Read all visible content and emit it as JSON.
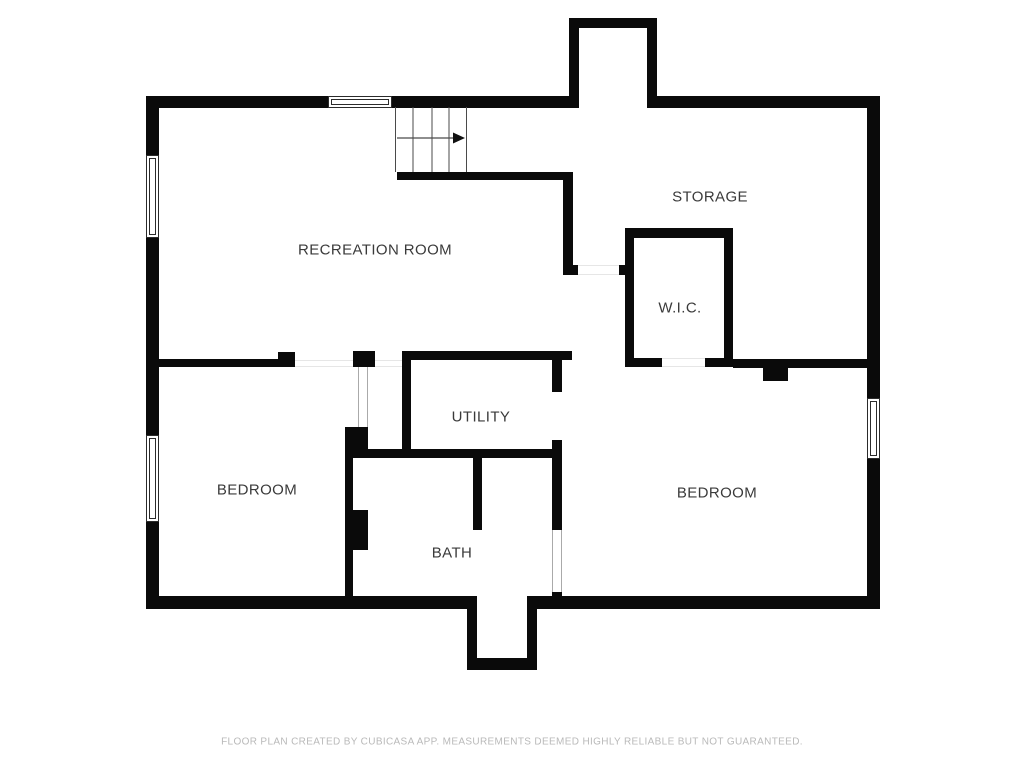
{
  "page": {
    "background": "#ffffff",
    "wall_color": "#0a0a0a",
    "label_color": "#3a3a3a",
    "footer_color": "#b9b9b9",
    "stair_line_color": "#4a4a4a"
  },
  "rooms": [
    {
      "name": "RECREATION ROOM",
      "cx": 375,
      "cy": 250
    },
    {
      "name": "STORAGE",
      "cx": 710,
      "cy": 197
    },
    {
      "name": "W.I.C.",
      "cx": 680,
      "cy": 308
    },
    {
      "name": "UTILITY",
      "cx": 481,
      "cy": 417
    },
    {
      "name": "BEDROOM",
      "cx": 257,
      "cy": 490
    },
    {
      "name": "BEDROOM",
      "cx": 717,
      "cy": 493
    },
    {
      "name": "BATH",
      "cx": 452,
      "cy": 553
    }
  ],
  "footer": {
    "text": "FLOOR PLAN CREATED BY CUBICASA APP. MEASUREMENTS DEEMED HIGHLY RELIABLE BUT NOT GUARANTEED.",
    "cx": 512,
    "cy": 742
  },
  "plan": {
    "walls": [
      {
        "x": 146,
        "y": 96,
        "w": 13,
        "h": 513
      },
      {
        "x": 146,
        "y": 96,
        "w": 182,
        "h": 12
      },
      {
        "x": 392,
        "y": 96,
        "w": 177,
        "h": 12
      },
      {
        "x": 569,
        "y": 18,
        "w": 10,
        "h": 90
      },
      {
        "x": 569,
        "y": 18,
        "w": 88,
        "h": 10
      },
      {
        "x": 647,
        "y": 18,
        "w": 10,
        "h": 90
      },
      {
        "x": 657,
        "y": 96,
        "w": 223,
        "h": 12
      },
      {
        "x": 867,
        "y": 96,
        "w": 13,
        "h": 513
      },
      {
        "x": 146,
        "y": 596,
        "w": 331,
        "h": 13
      },
      {
        "x": 527,
        "y": 596,
        "w": 353,
        "h": 13
      },
      {
        "x": 467,
        "y": 596,
        "w": 10,
        "h": 74
      },
      {
        "x": 467,
        "y": 658,
        "w": 70,
        "h": 12
      },
      {
        "x": 527,
        "y": 596,
        "w": 10,
        "h": 74
      },
      {
        "x": 397,
        "y": 172,
        "w": 176,
        "h": 8
      },
      {
        "x": 563,
        "y": 172,
        "w": 10,
        "h": 93
      },
      {
        "x": 563,
        "y": 265,
        "w": 15,
        "h": 10
      },
      {
        "x": 619,
        "y": 265,
        "w": 6,
        "h": 10
      },
      {
        "x": 625,
        "y": 228,
        "w": 9,
        "h": 139
      },
      {
        "x": 625,
        "y": 228,
        "w": 108,
        "h": 10
      },
      {
        "x": 724,
        "y": 228,
        "w": 9,
        "h": 139
      },
      {
        "x": 625,
        "y": 358,
        "w": 37,
        "h": 9
      },
      {
        "x": 705,
        "y": 358,
        "w": 28,
        "h": 9
      },
      {
        "x": 733,
        "y": 359,
        "w": 134,
        "h": 9
      },
      {
        "x": 763,
        "y": 368,
        "w": 25,
        "h": 13
      },
      {
        "x": 402,
        "y": 351,
        "w": 170,
        "h": 9
      },
      {
        "x": 402,
        "y": 351,
        "w": 9,
        "h": 107
      },
      {
        "x": 345,
        "y": 449,
        "w": 215,
        "h": 9
      },
      {
        "x": 552,
        "y": 360,
        "w": 10,
        "h": 32
      },
      {
        "x": 552,
        "y": 440,
        "w": 10,
        "h": 90
      },
      {
        "x": 552,
        "y": 592,
        "w": 10,
        "h": 8
      },
      {
        "x": 473,
        "y": 458,
        "w": 9,
        "h": 72
      },
      {
        "x": 345,
        "y": 427,
        "w": 23,
        "h": 31
      },
      {
        "x": 345,
        "y": 458,
        "w": 8,
        "h": 139
      },
      {
        "x": 353,
        "y": 510,
        "w": 15,
        "h": 40
      },
      {
        "x": 158,
        "y": 359,
        "w": 120,
        "h": 8
      },
      {
        "x": 278,
        "y": 352,
        "w": 17,
        "h": 15
      },
      {
        "x": 353,
        "y": 351,
        "w": 22,
        "h": 16
      }
    ],
    "windows": [
      {
        "x": 328,
        "y": 96,
        "w": 64,
        "h": 12,
        "o": "h"
      },
      {
        "x": 146,
        "y": 155,
        "w": 13,
        "h": 83,
        "o": "v"
      },
      {
        "x": 146,
        "y": 435,
        "w": 13,
        "h": 87,
        "o": "v"
      },
      {
        "x": 867,
        "y": 398,
        "w": 13,
        "h": 61,
        "o": "v"
      }
    ],
    "openings": [
      {
        "x": 358,
        "y": 367,
        "w": 10,
        "h": 60,
        "o": "v",
        "tone": "strong"
      },
      {
        "x": 552,
        "y": 530,
        "w": 10,
        "h": 62,
        "o": "v",
        "tone": "strong"
      },
      {
        "x": 662,
        "y": 358,
        "w": 43,
        "h": 9,
        "o": "h",
        "tone": "faint"
      },
      {
        "x": 295,
        "y": 360,
        "w": 58,
        "h": 7,
        "o": "h",
        "tone": "faint"
      },
      {
        "x": 375,
        "y": 360,
        "w": 27,
        "h": 7,
        "o": "h",
        "tone": "faint"
      },
      {
        "x": 578,
        "y": 265,
        "w": 41,
        "h": 10,
        "o": "h",
        "tone": "faint"
      }
    ],
    "stairs": {
      "x": 395,
      "y": 107,
      "w": 72,
      "h": 65,
      "tread_xs": [
        0.5,
        18,
        37,
        54,
        71.5
      ],
      "arrow_y": 31,
      "arrow_x1": 2,
      "arrow_x2": 58,
      "arrow_tip": 70
    }
  }
}
